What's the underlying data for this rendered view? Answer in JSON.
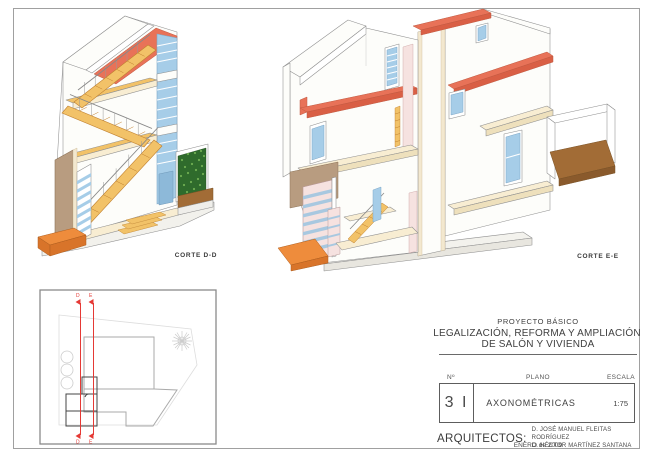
{
  "sheet": {
    "views": {
      "corte_dd": {
        "label": "CORTE D-D"
      },
      "corte_ee": {
        "label": "CORTE E-E"
      }
    },
    "key_plan": {
      "section_d_label": "D",
      "section_e_label": "E"
    },
    "title_block": {
      "project_type": "PROYECTO BÁSICO",
      "project_title_line1": "LEGALIZACIÓN, REFORMA Y AMPLIACIÓN",
      "project_title_line2": "DE SALÓN Y VIVIENDA",
      "number_header": "Nº",
      "plano_header": "PLANO",
      "escala_header": "ESCALA",
      "sheet_number": "3 I",
      "plano_value": "AXONOMÉTRICAS",
      "escala_value": "1:75",
      "architects_label": "ARQUITECTOS:",
      "architect_line1": "D. JOSÉ MANUEL FLEITAS RODRÍGUEZ",
      "architect_line2": "D. HÉCTOR MARTÍNEZ SANTANA",
      "date": "ENERO de 2009"
    },
    "palette": {
      "slab_red": "#e87258",
      "slab_red_dark": "#d95f45",
      "accent_orange": "#ee8c3c",
      "accent_orange_dark": "#d8742a",
      "stair_yellow": "#f2c268",
      "floor_cream": "#f8edd2",
      "floor_cream_dark": "#eade bc",
      "glass_blue": "#a6cde8",
      "glass_blue_dark": "#8db9d9",
      "hedge_green": "#2f6b2c",
      "hedge_green_light": "#6fae52",
      "ground_brown": "#a26c36",
      "wall_tan": "#b89c80",
      "door_pink": "#f6e2e0",
      "wall_white": "#fdfdfa",
      "outline": "#8f8f8f",
      "section_red": "#e53935"
    }
  }
}
